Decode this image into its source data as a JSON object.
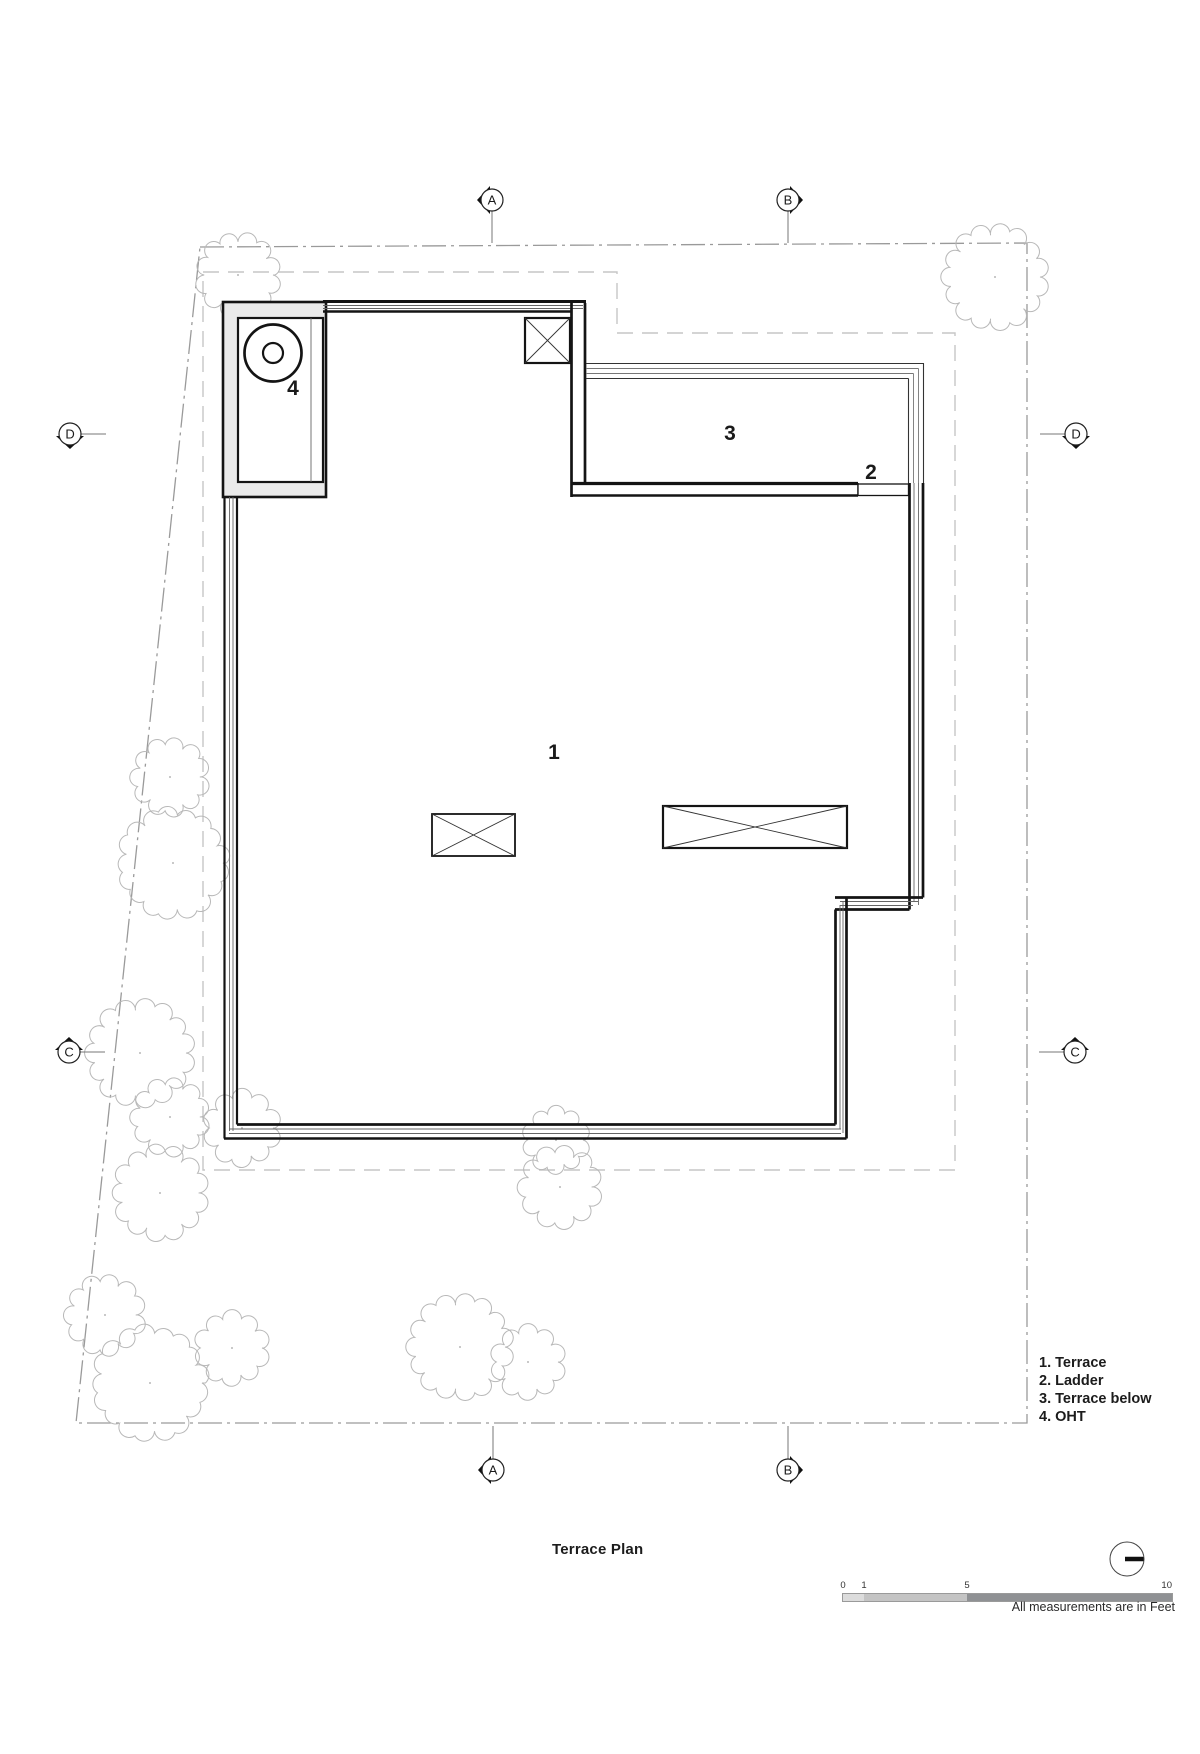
{
  "drawing_title": "Terrace Plan",
  "legend": {
    "items": [
      "1. Terrace",
      "2. Ladder",
      "3. Terrace below",
      "4. OHT"
    ]
  },
  "plan_labels": {
    "terrace": "1",
    "ladder": "2",
    "terrace_below": "3",
    "oht": "4"
  },
  "grid_markers": [
    {
      "id": "a-top",
      "letter": "A",
      "x": 492,
      "y": 200,
      "wedge": "left",
      "stem": [
        492,
        243
      ]
    },
    {
      "id": "b-top",
      "letter": "B",
      "x": 788,
      "y": 200,
      "wedge": "right",
      "stem": [
        788,
        243
      ]
    },
    {
      "id": "d-left",
      "letter": "D",
      "x": 70,
      "y": 434,
      "wedge": "down",
      "stem": [
        106,
        434
      ]
    },
    {
      "id": "d-right",
      "letter": "D",
      "x": 1076,
      "y": 434,
      "wedge": "down",
      "stem": [
        1040,
        434
      ]
    },
    {
      "id": "c-left",
      "letter": "C",
      "x": 69,
      "y": 1052,
      "wedge": "up",
      "stem": [
        105,
        1052
      ]
    },
    {
      "id": "c-right",
      "letter": "C",
      "x": 1075,
      "y": 1052,
      "wedge": "up",
      "stem": [
        1039,
        1052
      ]
    },
    {
      "id": "a-bottom",
      "letter": "A",
      "x": 493,
      "y": 1470,
      "wedge": "left",
      "stem": [
        493,
        1426
      ]
    },
    {
      "id": "b-bottom",
      "letter": "B",
      "x": 788,
      "y": 1470,
      "wedge": "right",
      "stem": [
        788,
        1426
      ]
    }
  ],
  "scale_bar": {
    "ticks": [
      {
        "label": "0",
        "x": 843
      },
      {
        "label": "1",
        "x": 864
      },
      {
        "label": "5",
        "x": 967
      },
      {
        "label": "10",
        "x": 1172
      }
    ],
    "note": "All measurements are in Feet"
  },
  "site": {
    "trees": [
      {
        "x": 238,
        "y": 275,
        "r": 35
      },
      {
        "x": 995,
        "y": 277,
        "r": 45
      },
      {
        "x": 170,
        "y": 777,
        "r": 32
      },
      {
        "x": 173,
        "y": 863,
        "r": 50
      },
      {
        "x": 140,
        "y": 1053,
        "r": 46
      },
      {
        "x": 170,
        "y": 1117,
        "r": 32
      },
      {
        "x": 160,
        "y": 1193,
        "r": 40
      },
      {
        "x": 242,
        "y": 1128,
        "r": 31
      },
      {
        "x": 556,
        "y": 1140,
        "r": 27
      },
      {
        "x": 560,
        "y": 1187,
        "r": 34
      },
      {
        "x": 105,
        "y": 1315,
        "r": 33
      },
      {
        "x": 150,
        "y": 1383,
        "r": 52
      },
      {
        "x": 232,
        "y": 1348,
        "r": 30
      },
      {
        "x": 460,
        "y": 1347,
        "r": 45
      },
      {
        "x": 528,
        "y": 1362,
        "r": 30
      }
    ]
  },
  "colors": {
    "wall": "#141414",
    "thin_line": "#666666",
    "property_line": "#9a9a9a",
    "setback_line": "#c6c6c6",
    "tree_line": "#b8b8b8",
    "oht_wall_fill": "#eaeaea",
    "scale_segments": [
      "#dcdcdc",
      "#c4c4c4",
      "#8f9194"
    ]
  }
}
